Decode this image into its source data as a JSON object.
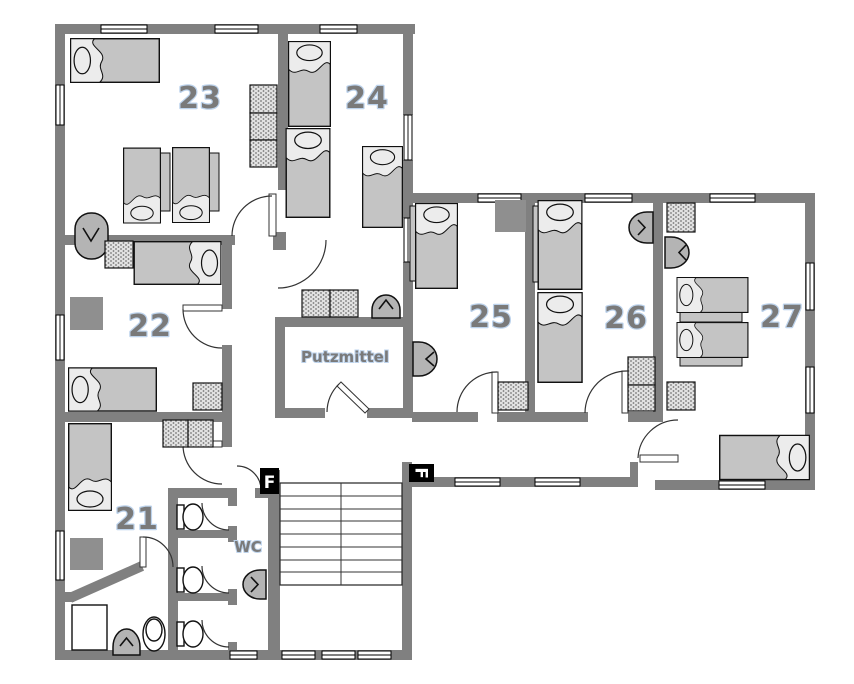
{
  "diagram": {
    "type": "floor-plan",
    "description": "Hostel floor plan with guest rooms 21-27, cleaning-supply closet, WC block and stairwell"
  },
  "labels": {
    "room21": "21",
    "room22": "22",
    "room23": "23",
    "room24": "24",
    "room25": "25",
    "room26": "26",
    "room27": "27",
    "putzmittel": "Putzmittel",
    "wc": "WC",
    "fire_symbol_1": "F",
    "fire_symbol_2": "F"
  },
  "colors": {
    "wall": "#808080",
    "bed": "#c4c4c4",
    "bedHead": "#ececec",
    "fixture": "#b4b4b4",
    "table": "#8f8f8f",
    "label": "#7a7a7a",
    "labelShadow": "#bdd3ec",
    "symbolBox": "#000000",
    "symbolText": "#ffffff"
  }
}
